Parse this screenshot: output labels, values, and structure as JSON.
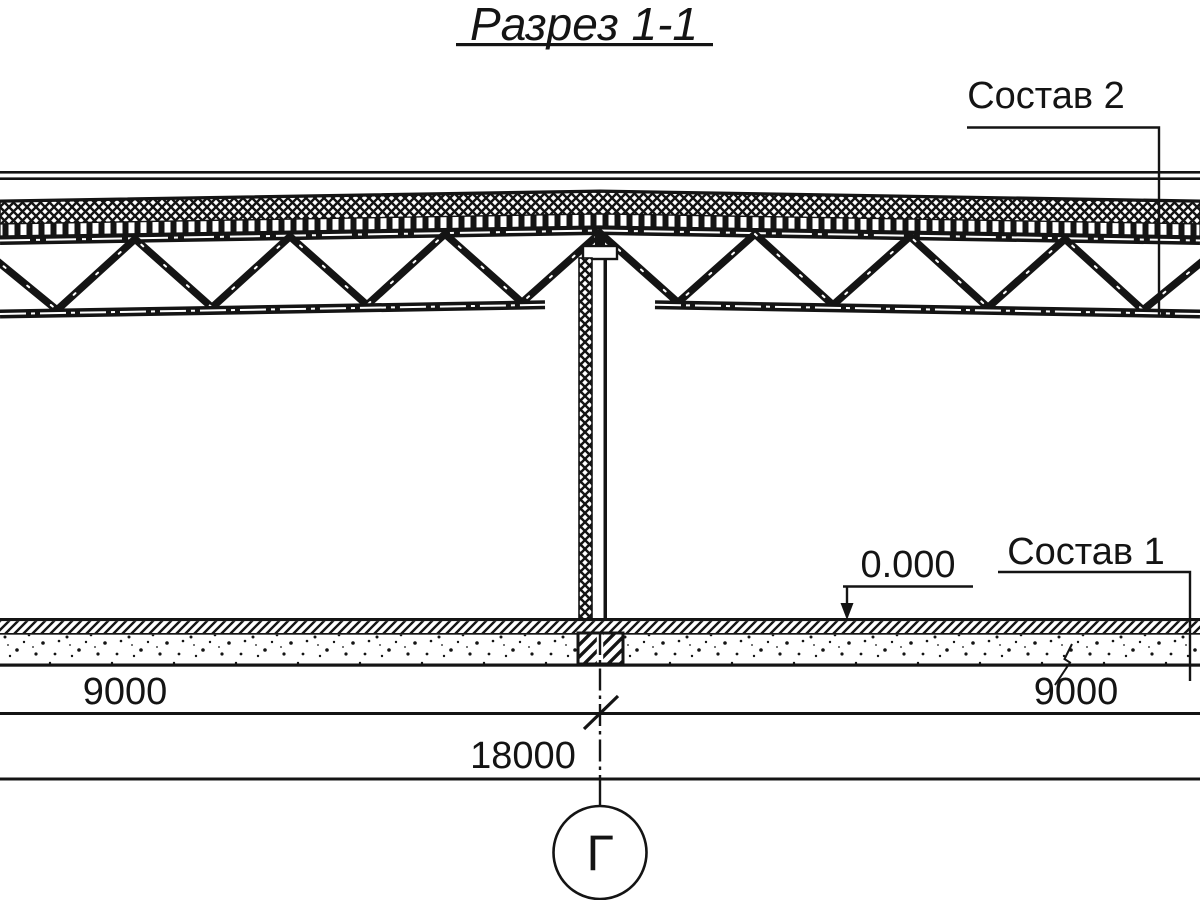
{
  "title": "Разрез 1-1",
  "callouts": {
    "roof_composition": "Состав 2",
    "floor_composition": "Состав 1"
  },
  "level_mark": "0.000",
  "dimensions": {
    "span_left": "9000",
    "span_right": "9000",
    "total": "18000"
  },
  "axis_marker": "Г",
  "colors": {
    "ink": "#141414",
    "paper": "#ffffff"
  }
}
